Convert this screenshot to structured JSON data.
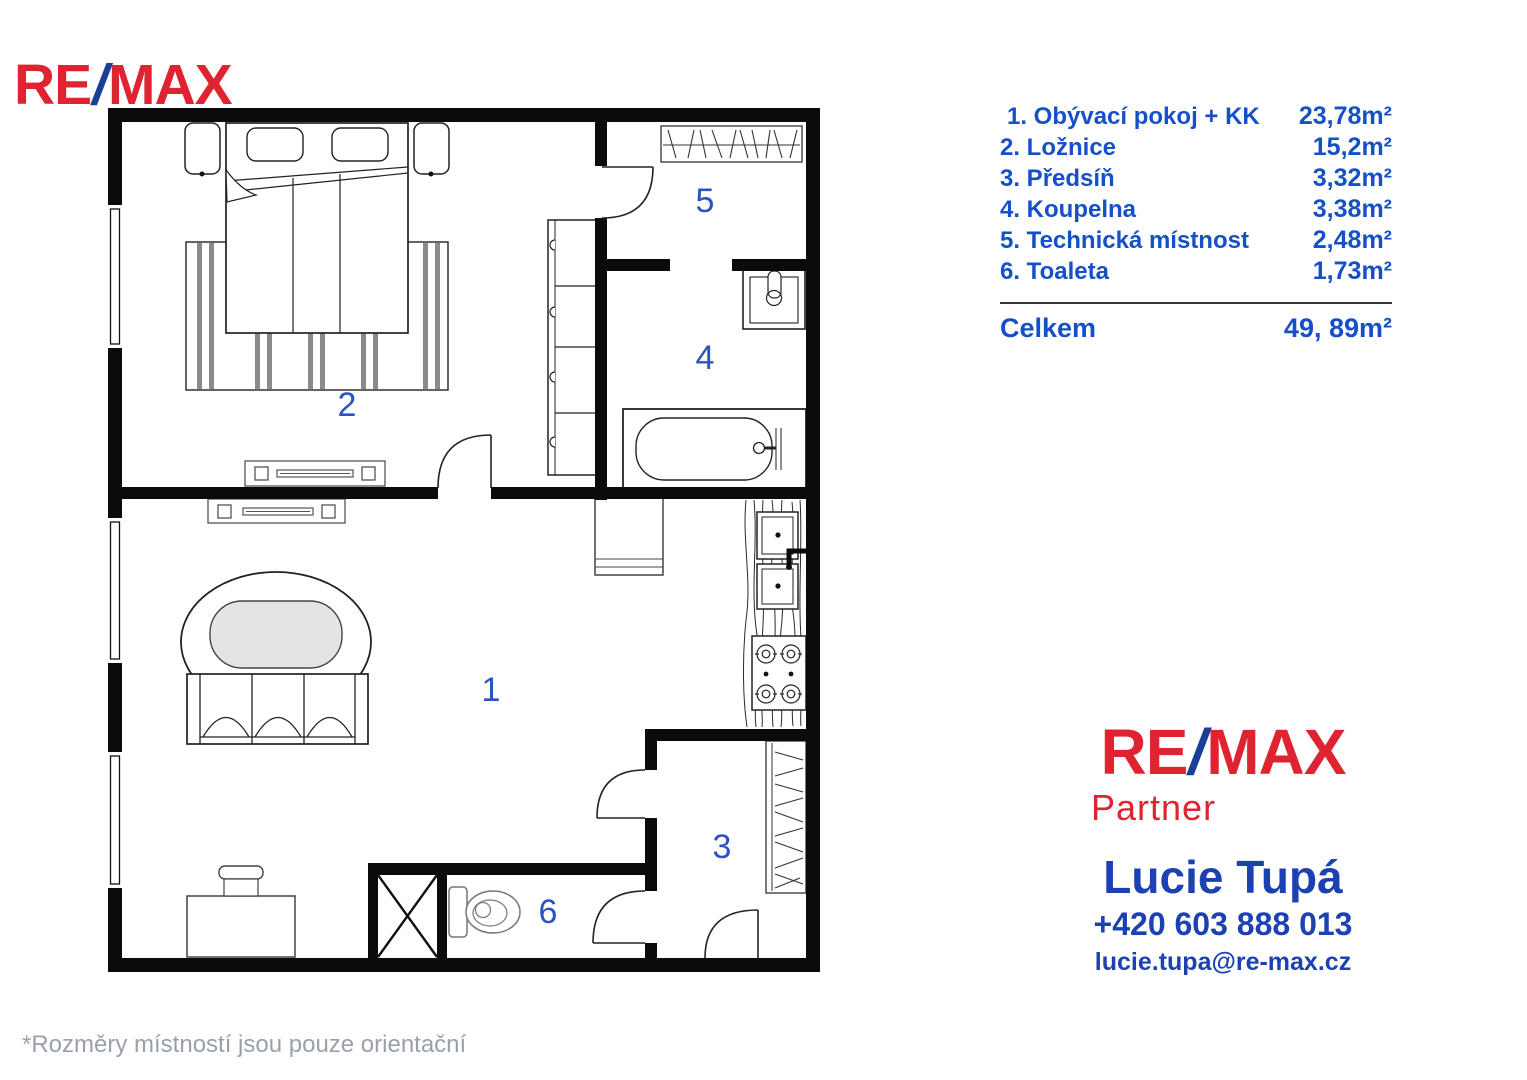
{
  "header_logo": {
    "re": "RE",
    "slash": "/",
    "max": "MAX"
  },
  "legend": {
    "items": [
      {
        "label": "1. Obývací pokoj + KK",
        "area": "23,78m²"
      },
      {
        "label": "2. Ložnice",
        "area": "15,2m²"
      },
      {
        "label": "3. Předsíň",
        "area": "3,32m²"
      },
      {
        "label": "4. Koupelna",
        "area": "3,38m²"
      },
      {
        "label": "5. Technická místnost",
        "area": "2,48m²"
      },
      {
        "label": "6. Toaleta",
        "area": "1,73m²"
      }
    ],
    "total_label": "Celkem",
    "total_area": "49, 89m²"
  },
  "agent": {
    "brand": {
      "re": "RE",
      "slash": "/",
      "max": "MAX",
      "sub": "Partner"
    },
    "name": "Lucie Tupá",
    "phone": "+420 603 888 013",
    "email": "lucie.tupa@re-max.cz"
  },
  "floorplan": {
    "room_labels": [
      "1",
      "2",
      "3",
      "4",
      "5",
      "6"
    ]
  },
  "footer": {
    "note": "*Rozměry místností jsou pouze orientační"
  },
  "colors": {
    "legend_blue": "#1550c8",
    "contact_blue": "#1c41b2",
    "remax_red": "#e02330",
    "slash_blue": "#1b3f97",
    "room_number_blue": "#2b52c2",
    "footer_gray": "#9aa0aa",
    "wall_black": "#0b0b0b"
  }
}
